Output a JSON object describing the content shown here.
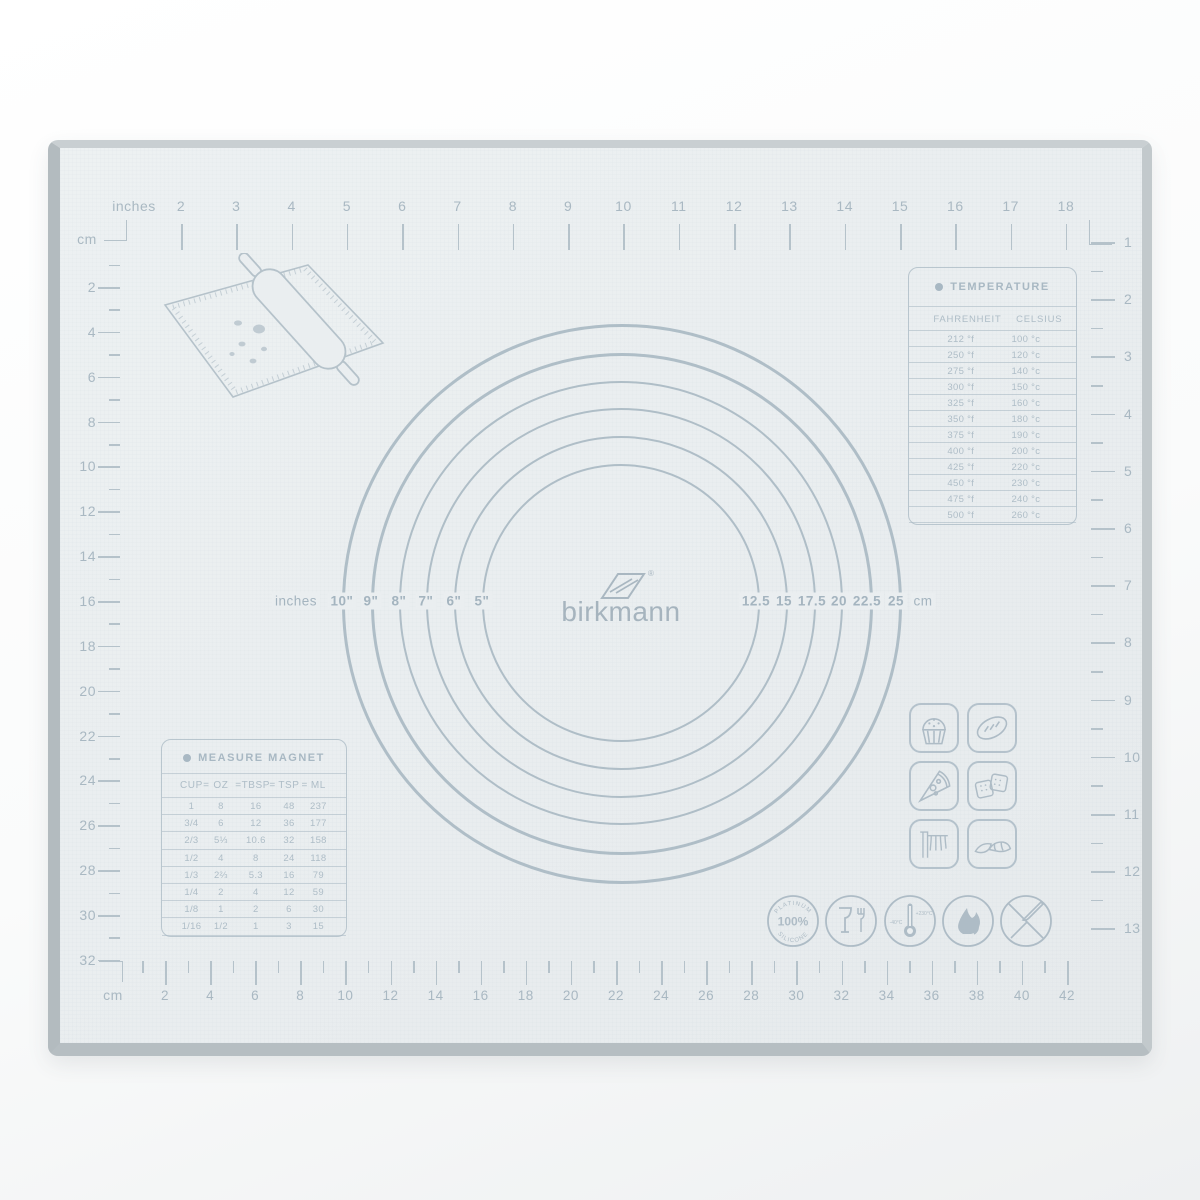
{
  "brand": {
    "name": "birkmann",
    "registered": "®"
  },
  "colors": {
    "mat": "#eaeef0",
    "ink": "#b5c2ca",
    "text": "#a9b8c2"
  },
  "rulers": {
    "top": {
      "unit": "inches",
      "numbers": [
        2,
        3,
        4,
        5,
        6,
        7,
        8,
        9,
        10,
        11,
        12,
        13,
        14,
        15,
        16,
        17,
        18
      ]
    },
    "left": {
      "unit": "cm",
      "numbers": [
        2,
        4,
        6,
        8,
        10,
        12,
        14,
        16,
        18,
        20,
        22,
        24,
        26,
        28,
        30,
        32
      ]
    },
    "bottom": {
      "unit": "cm",
      "numbers": [
        2,
        4,
        6,
        8,
        10,
        12,
        14,
        16,
        18,
        20,
        22,
        24,
        26,
        28,
        30,
        32,
        34,
        36,
        38,
        40,
        42
      ]
    },
    "right": {
      "numbers": [
        1,
        2,
        3,
        4,
        5,
        6,
        7,
        8,
        9,
        10,
        11,
        12,
        13
      ]
    }
  },
  "circles": {
    "left_unit": "inches",
    "left_values": [
      "10\"",
      "9\"",
      "8\"",
      "7\"",
      "6\"",
      "5\""
    ],
    "right_values": [
      "12.5",
      "15",
      "17.5",
      "20",
      "22.5",
      "25"
    ],
    "right_unit": "cm"
  },
  "temperature": {
    "title": "TEMPERATURE",
    "columns": [
      "FAHRENHEIT",
      "CELSIUS"
    ],
    "rows": [
      [
        "212 °f",
        "100 °c"
      ],
      [
        "250 °f",
        "120 °c"
      ],
      [
        "275 °f",
        "140 °c"
      ],
      [
        "300 °f",
        "150 °c"
      ],
      [
        "325 °f",
        "160 °c"
      ],
      [
        "350 °f",
        "180 °c"
      ],
      [
        "375 °f",
        "190 °c"
      ],
      [
        "400 °f",
        "200 °c"
      ],
      [
        "425 °f",
        "220 °c"
      ],
      [
        "450 °f",
        "230 °c"
      ],
      [
        "475 °f",
        "240 °c"
      ],
      [
        "500 °f",
        "260 °c"
      ]
    ]
  },
  "measure": {
    "title": "MEASURE MAGNET",
    "columns": [
      "CUP",
      "OZ",
      "TBSP",
      "TSP",
      "ML"
    ],
    "separator": "=",
    "rows": [
      [
        "1",
        "8",
        "16",
        "48",
        "237"
      ],
      [
        "3/4",
        "6",
        "12",
        "36",
        "177"
      ],
      [
        "2/3",
        "5⅓",
        "10.6",
        "32",
        "158"
      ],
      [
        "1/2",
        "4",
        "8",
        "24",
        "118"
      ],
      [
        "1/3",
        "2⅔",
        "5.3",
        "16",
        "79"
      ],
      [
        "1/4",
        "2",
        "4",
        "12",
        "59"
      ],
      [
        "1/8",
        "1",
        "2",
        "6",
        "30"
      ],
      [
        "1/16",
        "1/2",
        "1",
        "3",
        "15"
      ]
    ]
  },
  "food_icons": [
    "cupcake",
    "bread",
    "pizza",
    "crackers",
    "pasta",
    "croissant"
  ],
  "cert": {
    "platinum": {
      "top": "PLATINUM",
      "center": "100%",
      "bottom": "SILICONE"
    },
    "thermometer": {
      "min": "-40°C",
      "max": "+230°C"
    }
  }
}
